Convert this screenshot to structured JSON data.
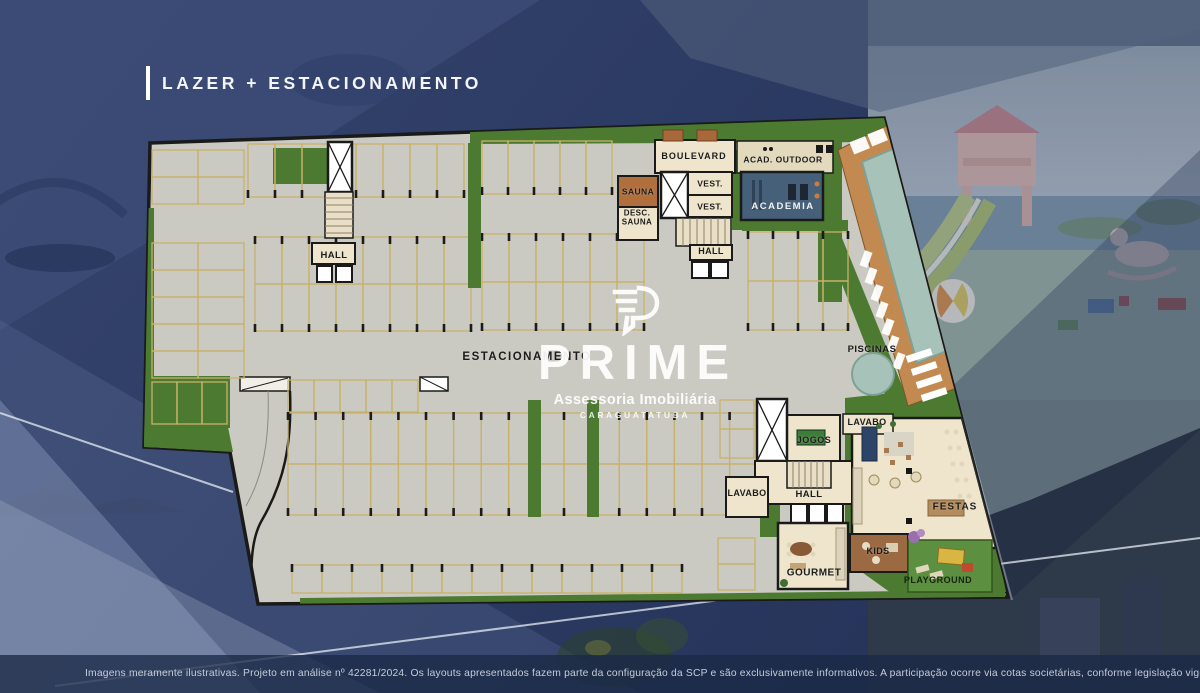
{
  "title": "LAZER + ESTACIONAMENTO",
  "watermark": {
    "brand": "PRIME",
    "subtitle": "Assessoria Imobiliária",
    "city": "CARAGUATATUBA",
    "logo_icon": "prime-p-logo"
  },
  "disclaimer": "Imagens meramente ilustrativas. Projeto em análise nº 42281/2024. Os layouts apresentados fazem parte da configuração da SCP e são exclusivamente informativos. A participação ocorre via cotas societárias, conforme legislação vigente.",
  "floorplan": {
    "labels": [
      {
        "id": "boulevard",
        "text": "BOULEVARD",
        "x": 694,
        "y": 157,
        "fs": 9,
        "ls": 1
      },
      {
        "id": "acad-outdoor",
        "text": "ACAD. OUTDOOR",
        "x": 783,
        "y": 160,
        "fs": 8.5,
        "ls": 0.5
      },
      {
        "id": "sauna",
        "text": "SAUNA",
        "x": 638,
        "y": 192,
        "fs": 8.5
      },
      {
        "id": "vest-1",
        "text": "VEST.",
        "x": 710,
        "y": 184,
        "fs": 8.5
      },
      {
        "id": "vest-2",
        "text": "VEST.",
        "x": 710,
        "y": 207,
        "fs": 8.5
      },
      {
        "id": "desc-sauna",
        "text": "DESC.\nSAUNA",
        "x": 637,
        "y": 218,
        "fs": 8
      },
      {
        "id": "academia",
        "text": "ACADEMIA",
        "x": 783,
        "y": 207,
        "fs": 9.5,
        "ls": 1.5,
        "color": "#f2f2ef"
      },
      {
        "id": "hall-top",
        "text": "HALL",
        "x": 711,
        "y": 252,
        "fs": 9
      },
      {
        "id": "hall-left",
        "text": "HALL",
        "x": 334,
        "y": 256,
        "fs": 9.5
      },
      {
        "id": "estacionamento",
        "text": "ESTACIONAMENTO",
        "x": 527,
        "y": 357,
        "fs": 11.5,
        "ls": 1.5
      },
      {
        "id": "piscinas",
        "text": "PISCINAS",
        "x": 872,
        "y": 350,
        "fs": 9.5,
        "ls": 0.5
      },
      {
        "id": "jogos",
        "text": "JOGOS",
        "x": 814,
        "y": 441,
        "fs": 9,
        "ls": 0.5
      },
      {
        "id": "lavabo-top",
        "text": "LAVABO",
        "x": 867,
        "y": 423,
        "fs": 9
      },
      {
        "id": "lavabo-left",
        "text": "LAVABO",
        "x": 747,
        "y": 494,
        "fs": 9
      },
      {
        "id": "hall-bottom",
        "text": "HALL",
        "x": 809,
        "y": 495,
        "fs": 9.5
      },
      {
        "id": "festas",
        "text": "FESTAS",
        "x": 955,
        "y": 508,
        "fs": 10,
        "ls": 1
      },
      {
        "id": "kids",
        "text": "KIDS",
        "x": 878,
        "y": 552,
        "fs": 9
      },
      {
        "id": "gourmet",
        "text": "GOURMET",
        "x": 814,
        "y": 574,
        "fs": 10,
        "ls": 0.5
      },
      {
        "id": "playground",
        "text": "PLAYGROUND",
        "x": 938,
        "y": 581,
        "fs": 9,
        "ls": 0.5,
        "color": "#17250e"
      }
    ],
    "parking_groups": [
      {
        "x": 248,
        "y": 144,
        "cols": 8,
        "cw": 27,
        "ch": 53,
        "tick": "bottom"
      },
      {
        "x": 482,
        "y": 141,
        "cols": 5,
        "cw": 26,
        "ch": 53,
        "tick": "bottom"
      },
      {
        "x": 255,
        "y": 237,
        "cols": 8,
        "cw": 27,
        "ch": 47,
        "tick": "top"
      },
      {
        "x": 255,
        "y": 284,
        "cols": 8,
        "cw": 27,
        "ch": 47,
        "tick": "bottom"
      },
      {
        "x": 482,
        "y": 234,
        "cols": 6,
        "cw": 27,
        "ch": 48,
        "tick": "top"
      },
      {
        "x": 482,
        "y": 282,
        "cols": 6,
        "cw": 27,
        "ch": 48,
        "tick": "bottom"
      },
      {
        "x": 748,
        "y": 232,
        "cols": 4,
        "cw": 25,
        "ch": 49,
        "tick": "top"
      },
      {
        "x": 748,
        "y": 281,
        "cols": 4,
        "cw": 25,
        "ch": 49,
        "tick": "bottom"
      },
      {
        "x": 288,
        "y": 380,
        "cols": 5,
        "cw": 26,
        "ch": 32,
        "tick": "none"
      },
      {
        "x": 288,
        "y": 413,
        "cols": 17,
        "cw": 27.6,
        "ch": 51,
        "tick": "top"
      },
      {
        "x": 288,
        "y": 464,
        "cols": 17,
        "cw": 27.6,
        "ch": 51,
        "tick": "bottom"
      },
      {
        "x": 292,
        "y": 565,
        "cols": 13,
        "cw": 30,
        "ch": 28,
        "tick": "top"
      },
      {
        "x": 152,
        "y": 150,
        "cols": 2,
        "rows": 2,
        "cw": 46,
        "ch": 27,
        "orient": "h",
        "tick": "none"
      },
      {
        "x": 152,
        "y": 243,
        "cols": 2,
        "rows": 5,
        "cw": 46,
        "ch": 27,
        "orient": "h",
        "tick": "none"
      },
      {
        "x": 152,
        "y": 382,
        "cols": 3,
        "cw": 25,
        "ch": 42,
        "tick": "none"
      },
      {
        "x": 720,
        "y": 400,
        "cols": 1,
        "rows": 2,
        "cw": 34,
        "ch": 29,
        "orient": "h",
        "tick": "none"
      },
      {
        "x": 718,
        "y": 538,
        "cols": 1,
        "rows": 2,
        "cw": 37,
        "ch": 26,
        "orient": "h",
        "tick": "none"
      }
    ]
  },
  "colors": {
    "navy": "#2c3b63",
    "navy-dark": "#1b2947",
    "panel-light": "#93a2c4",
    "concrete": "#cbcac2",
    "wall": "#1a1a1a",
    "grass": "#4c7a31",
    "grass-bright": "#5c9040",
    "stall": "#c8b26a",
    "tick": "#1b1b1b",
    "beige": "#eee5cc",
    "stair": "#e9dfc6",
    "wood": "#b06f3d",
    "deck": "#c28a50",
    "pool": "#a6c2b9",
    "academia-slate": "#47607a",
    "kids-brown": "#9c6a42",
    "watermark-white": "#ffffff",
    "disclaimer-text": "#c6cdda"
  }
}
